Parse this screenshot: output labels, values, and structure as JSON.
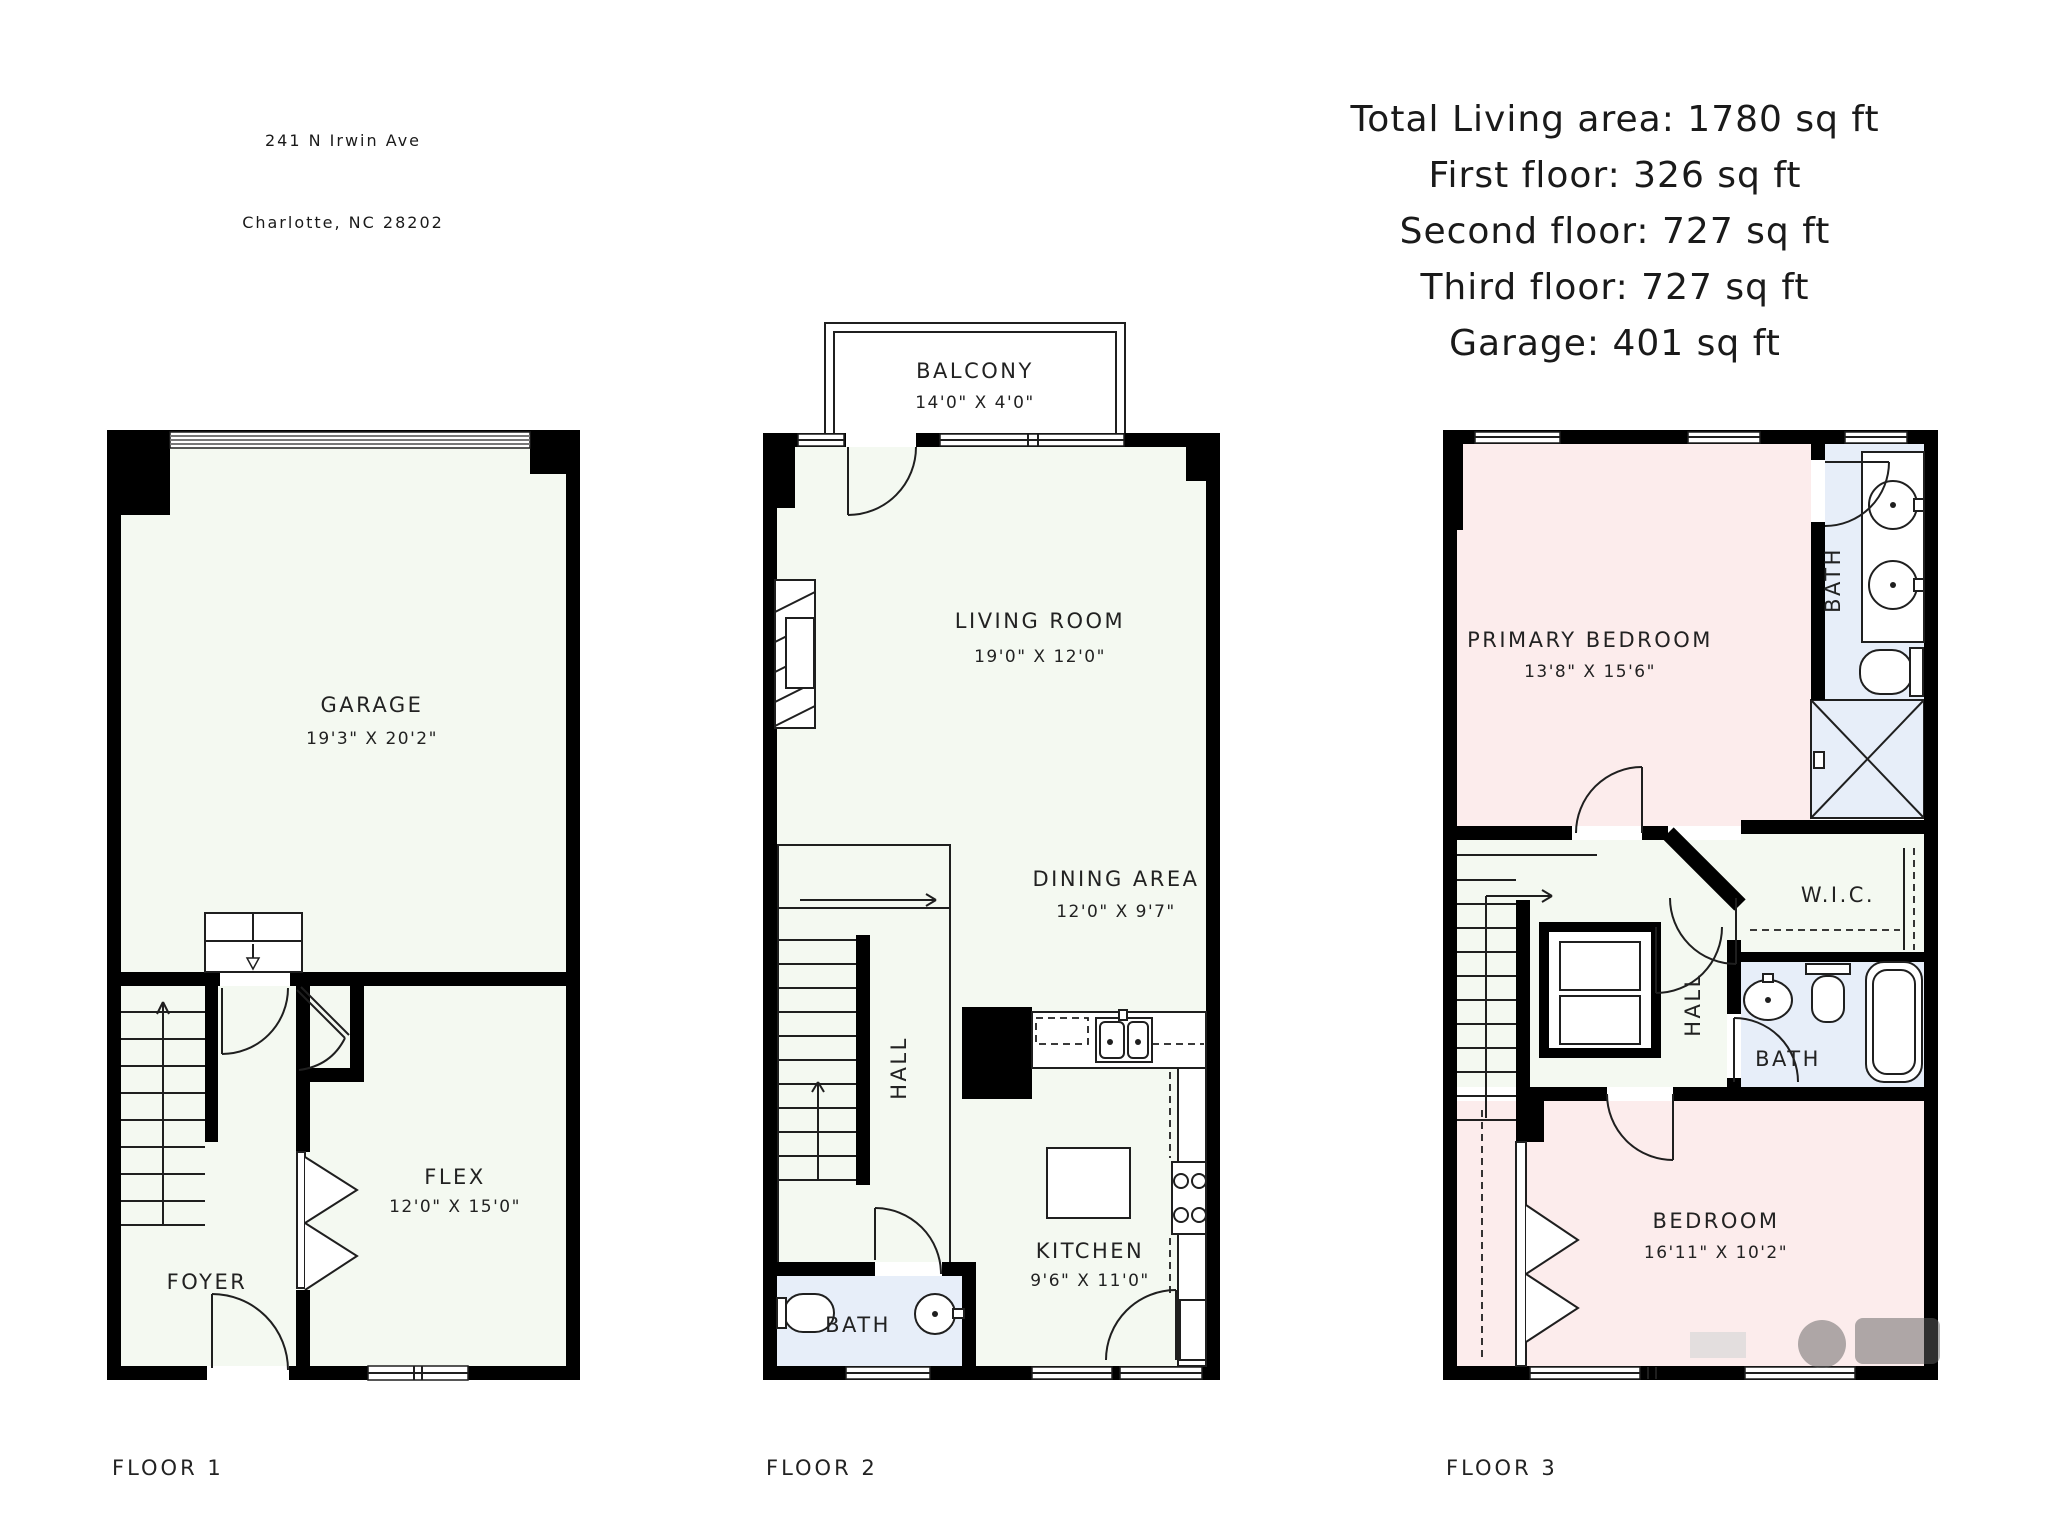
{
  "header": {
    "address_line1": "241 N Irwin Ave",
    "address_line2": "Charlotte, NC 28202"
  },
  "summary": {
    "line1": "Total Living area: 1780 sq ft",
    "line2": "First floor: 326 sq ft",
    "line3": "Second floor: 727 sq ft",
    "line4": "Third floor: 727 sq ft",
    "line5": "Garage: 401 sq ft"
  },
  "floor1": {
    "label": "FLOOR 1",
    "garage_name": "GARAGE",
    "garage_dims": "19'3\" X 20'2\"",
    "flex_name": "FLEX",
    "flex_dims": "12'0\" X 15'0\"",
    "foyer_name": "FOYER"
  },
  "floor2": {
    "label": "FLOOR 2",
    "balcony_name": "BALCONY",
    "balcony_dims": "14'0\" X 4'0\"",
    "living_name": "LIVING ROOM",
    "living_dims": "19'0\" X 12'0\"",
    "dining_name": "DINING AREA",
    "dining_dims": "12'0\" X 9'7\"",
    "kitchen_name": "KITCHEN",
    "kitchen_dims": "9'6\" X 11'0\"",
    "hall_name": "HALL",
    "bath_name": "BATH"
  },
  "floor3": {
    "label": "FLOOR 3",
    "primary_name": "PRIMARY BEDROOM",
    "primary_dims": "13'8\" X 15'6\"",
    "bath1_name": "BATH",
    "wic_name": "W.I.C.",
    "hall_name": "HALL",
    "bath2_name": "BATH",
    "bedroom_name": "BEDROOM",
    "bedroom_dims": "16'11\" X 10'2\""
  },
  "colors": {
    "wall": "#000000",
    "room": "#f4f9f1",
    "bath": "#e7eef9",
    "bedroom": "#fcecec",
    "line": "#1f1f1f",
    "text": "#1a1a1a",
    "winline": "#777777"
  }
}
